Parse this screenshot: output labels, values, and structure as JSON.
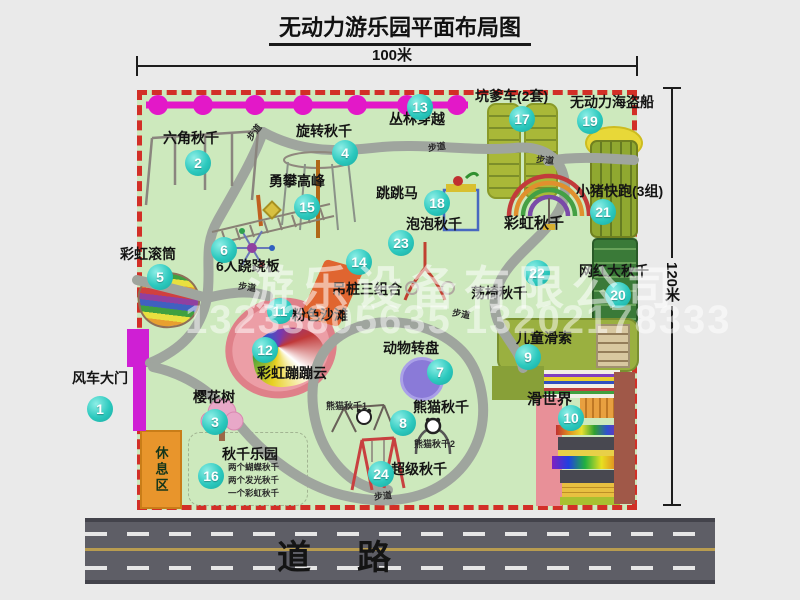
{
  "title": "无动力游乐园平面布局图",
  "dim_width": "100米",
  "dim_height": "120米",
  "road_label": "道路",
  "walkway_label": "步道",
  "rest_area_label": "休息区",
  "rainbow_swing_label": "彩虹秋千",
  "panda_swing_1": "熊猫秋千1",
  "panda_swing_2": "熊猫秋千2",
  "swing_park_notes": [
    "两个蝴蝶秋千",
    "两个发光秋千",
    "一个彩虹秋千"
  ],
  "watermark": {
    "company": "游乐设备有限公司",
    "phones": "13233805635 13202178333"
  },
  "colors": {
    "map_bg": "#cde9bd",
    "boundary_red": "#d22f27",
    "badge_teal": "#2cc9be",
    "path_gray": "#9fa59e",
    "zipline_magenta": "#e318c8",
    "gate_magenta": "#cf1fd4",
    "rest_area_orange": "#e8952c",
    "road_gray": "#5e5e66"
  },
  "attractions": [
    {
      "num": "1",
      "label": "风车大门"
    },
    {
      "num": "2",
      "label": "六角秋千"
    },
    {
      "num": "3",
      "label": "樱花树"
    },
    {
      "num": "4",
      "label": "旋转秋千"
    },
    {
      "num": "5",
      "label": "彩虹滚筒"
    },
    {
      "num": "6",
      "label": "6人跷跷板"
    },
    {
      "num": "7",
      "label": "动物转盘"
    },
    {
      "num": "8",
      "label": "熊猫秋千"
    },
    {
      "num": "9",
      "label": "儿童滑索"
    },
    {
      "num": "10",
      "label": "滑世界"
    },
    {
      "num": "11",
      "label": "粉色沙滩"
    },
    {
      "num": "12",
      "label": "彩虹蹦蹦云"
    },
    {
      "num": "13",
      "label": "丛林穿越"
    },
    {
      "num": "14",
      "label": "吊桩三组合"
    },
    {
      "num": "15",
      "label": "勇攀高峰"
    },
    {
      "num": "16",
      "label": "秋千乐园"
    },
    {
      "num": "17",
      "label": "坑爹车(2套)"
    },
    {
      "num": "18",
      "label": "跳跳马"
    },
    {
      "num": "19",
      "label": "无动力海盗船"
    },
    {
      "num": "20",
      "label": "网红大秋千"
    },
    {
      "num": "21",
      "label": "小猪快跑(3组)"
    },
    {
      "num": "22",
      "label": "荡椅秋千"
    },
    {
      "num": "23",
      "label": "泡泡秋千"
    },
    {
      "num": "24",
      "label": "超级秋千"
    }
  ]
}
